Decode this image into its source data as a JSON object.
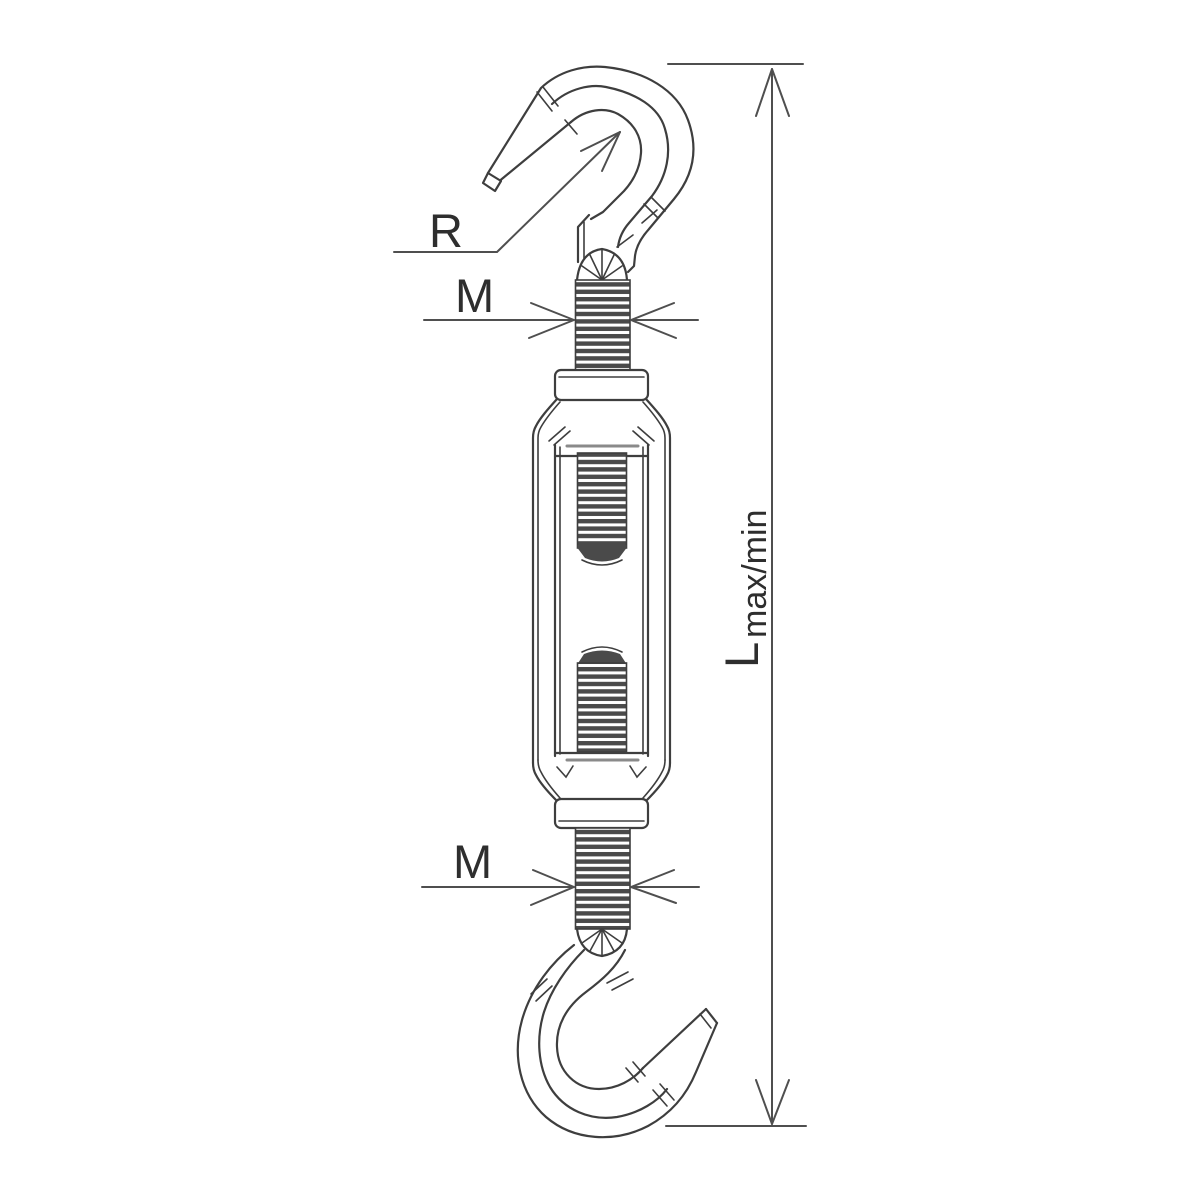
{
  "labels": {
    "radius": "R",
    "thread_top": "M",
    "thread_bottom": "M",
    "length_main": "L",
    "length_sub": "max/min"
  },
  "colors": {
    "background": "#ffffff",
    "line": "#3e3e3e",
    "dimension_line": "#4f4f4f",
    "thread_fill": "#4a4a4a",
    "light_inner_line": "#8a8a8a",
    "label_text": "#2e2e2e"
  }
}
